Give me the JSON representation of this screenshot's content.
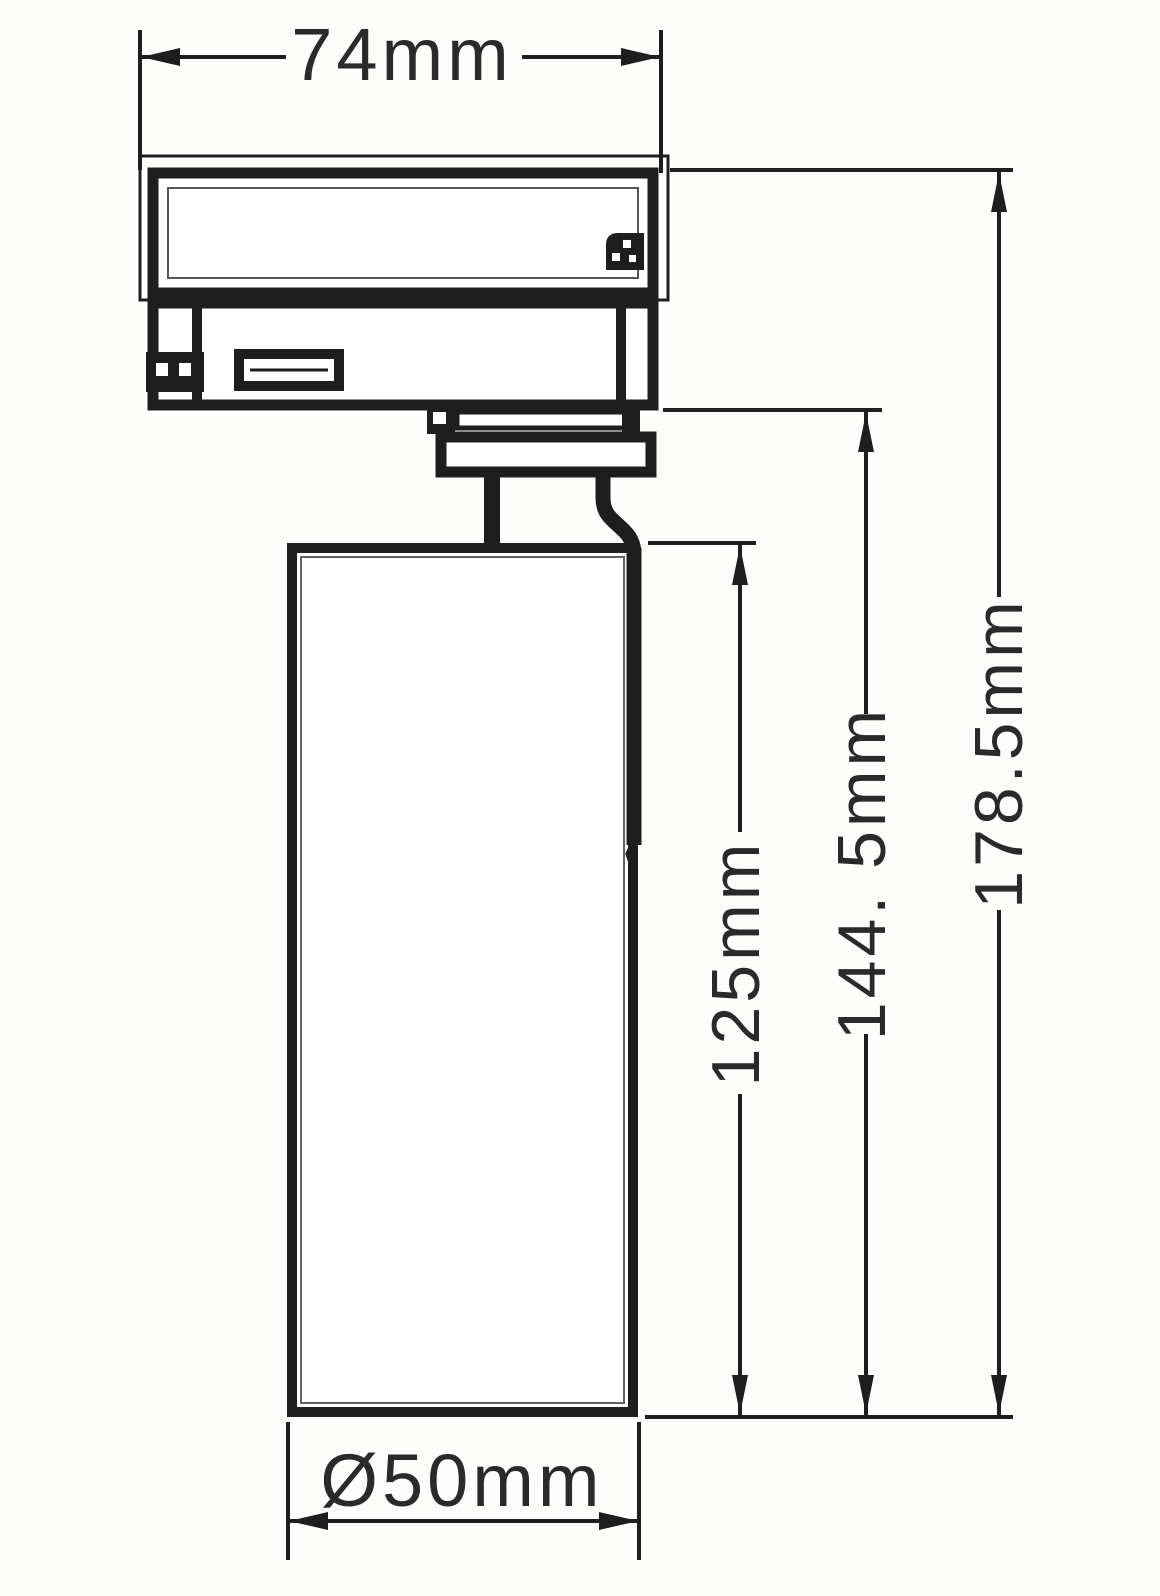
{
  "drawing": {
    "type": "technical-dimension-drawing",
    "subject": "LED track spotlight side elevation",
    "background_color": "#fdfdfb",
    "line_color": "#1e1e1e",
    "text_color": "#2a2a2a",
    "dimensions": [
      {
        "id": "adapter-width",
        "label": "74mm",
        "orientation": "horizontal",
        "measures": "track adapter width"
      },
      {
        "id": "total-height",
        "label": "178.5mm",
        "orientation": "vertical",
        "measures": "overall fixture height"
      },
      {
        "id": "collar-height",
        "label": "144. 5mm",
        "orientation": "vertical",
        "measures": "height from collar to lamp bottom"
      },
      {
        "id": "body-height",
        "label": "125mm",
        "orientation": "vertical",
        "measures": "cylindrical lamp body height"
      },
      {
        "id": "body-diameter",
        "label": "Ø50mm",
        "orientation": "horizontal",
        "measures": "lamp body diameter"
      }
    ]
  }
}
